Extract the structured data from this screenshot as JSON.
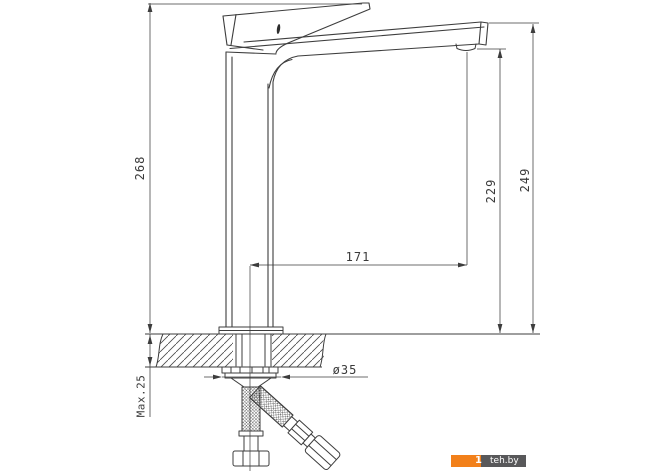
{
  "diagram": {
    "type": "technical-drawing",
    "subject": "tall single-lever basin mixer faucet, side view with installation dimensions",
    "units": "mm",
    "labels": {
      "height_total": "268",
      "height_to_spout_top": "249",
      "height_to_outlet": "229",
      "spout_reach": "171",
      "max_mounting_thickness": "Max.25",
      "hole_diameter": "ø35"
    },
    "colors": {
      "line": "#3d3d3d",
      "background": "#ffffff"
    }
  },
  "watermark": {
    "prefix": "1",
    "site": "teh.by",
    "orange": "#f2801a",
    "gray": "#58585a"
  }
}
